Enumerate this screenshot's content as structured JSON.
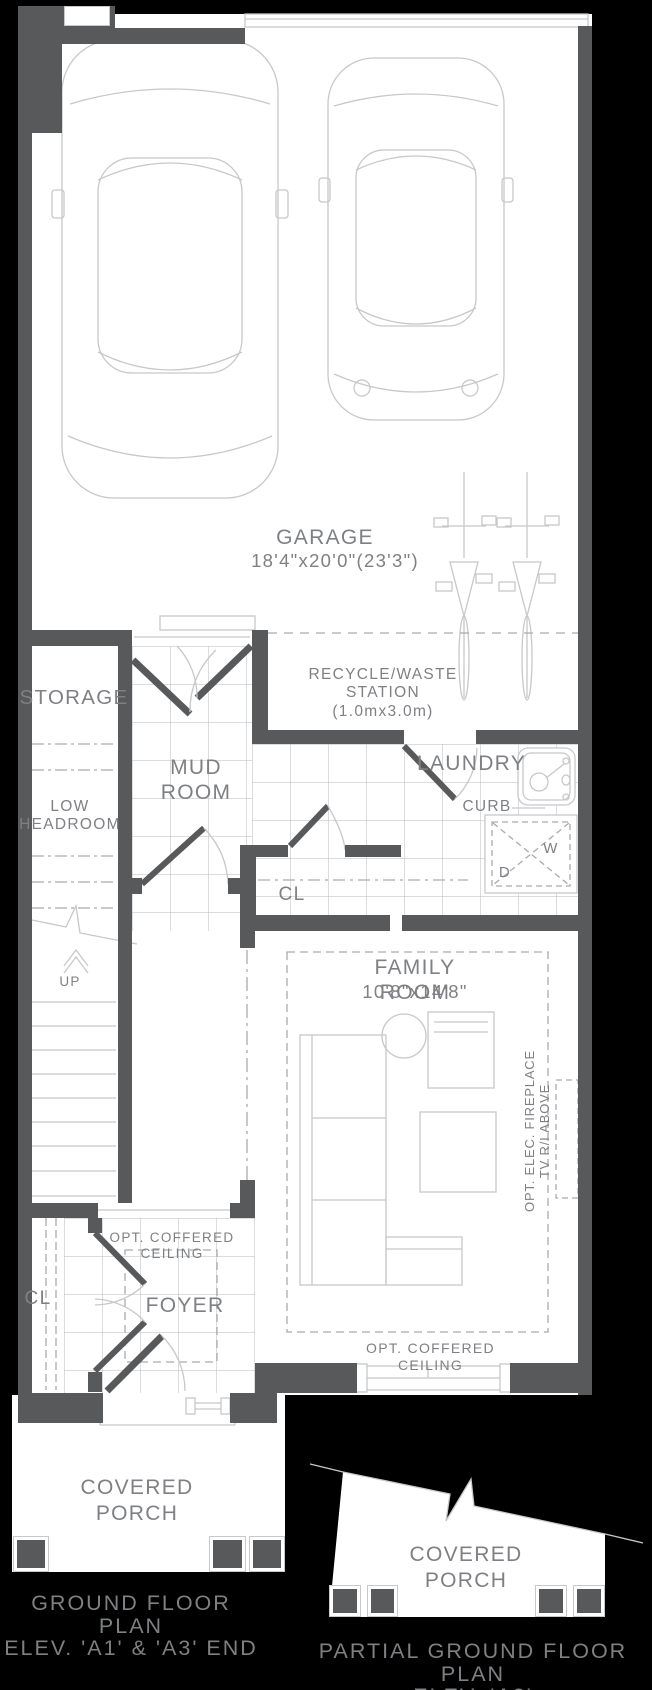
{
  "colors": {
    "bg": "#000000",
    "floor": "#ffffff",
    "wall": "#58595b",
    "line": "#c7c8ca",
    "dash": "#a9abae",
    "text": "#7e8083"
  },
  "rooms": {
    "garage": {
      "name": "GARAGE",
      "dims": "18'4\"x20'0\"(23'3\")"
    },
    "recycle": {
      "line1": "RECYCLE/WASTE STATION",
      "line2": "(1.0mx3.0m)"
    },
    "storage": {
      "name": "STORAGE"
    },
    "low_headroom": {
      "line1": "LOW",
      "line2": "HEADROOM"
    },
    "mud_room": {
      "line1": "MUD",
      "line2": "ROOM"
    },
    "laundry": {
      "name": "LAUNDRY"
    },
    "curb": {
      "name": "CURB"
    },
    "washer": "W",
    "dryer": "D",
    "closet_hall": "CL",
    "family_room": {
      "name": "FAMILY ROOM",
      "dims": "10'8\"x14'8\""
    },
    "fireplace_note": {
      "line1": "OPT. ELEC. FIREPLACE",
      "line2": "TV R/I ABOVE"
    },
    "coffered_family": "OPT. COFFERED CEILING",
    "foyer": {
      "name": "FOYER",
      "coffered_line1": "OPT. COFFERED",
      "coffered_line2": "CEILING"
    },
    "closet_foyer": "CL",
    "stairs_up": "UP",
    "porch_main": {
      "line1": "COVERED",
      "line2": "PORCH"
    },
    "porch_partial": {
      "line1": "COVERED",
      "line2": "PORCH"
    }
  },
  "titles": {
    "main": {
      "line1": "GROUND FLOOR PLAN",
      "line2": "ELEV. 'A1' & 'A3' END"
    },
    "partial": {
      "line1": "PARTIAL GROUND FLOOR PLAN",
      "line2": "ELEV. 'A2'"
    }
  }
}
